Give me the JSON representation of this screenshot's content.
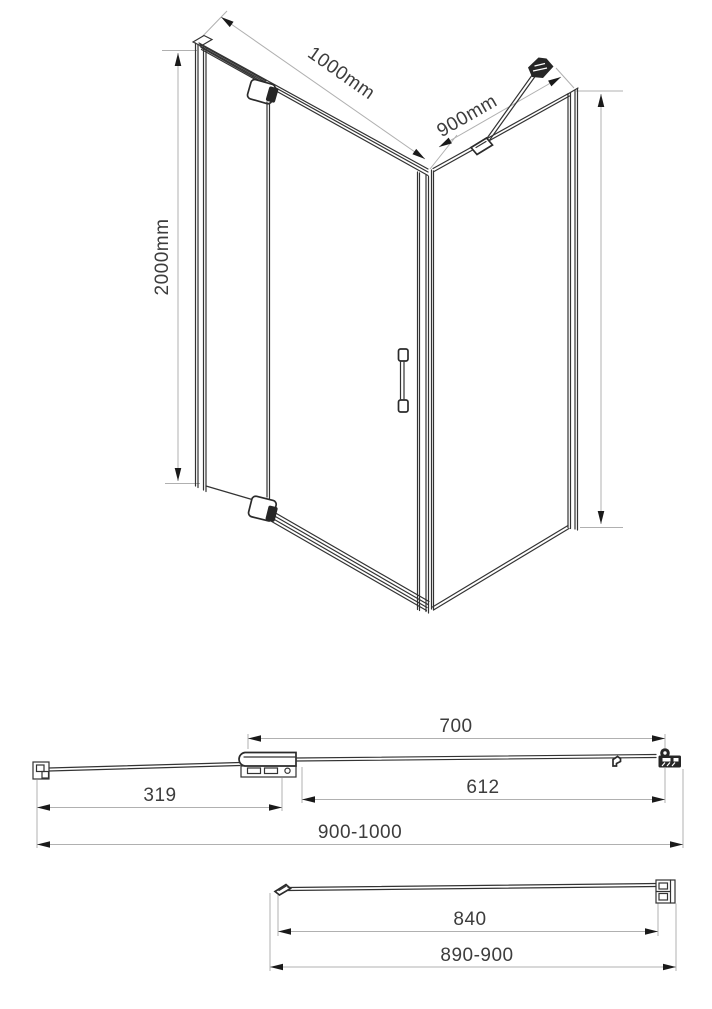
{
  "drawing": {
    "title": "shower-enclosure-technical-drawing",
    "iso": {
      "front_width": "1000mm",
      "side_width": "900mm",
      "height": "2000mm"
    },
    "door_plan": {
      "wall_to_hinge": "319",
      "hinge_to_edge": "700",
      "glass_width": "612",
      "overall_width": "900-1000"
    },
    "side_plan": {
      "glass_width": "840",
      "overall_width": "890-900"
    }
  },
  "colors": {
    "background": "#ffffff",
    "structure_line": "#333333",
    "dimension_line": "#b0b0b0",
    "arrow": "#1a1a1a",
    "label_text": "#3d3d3d",
    "fitting_fill": "#262626"
  }
}
